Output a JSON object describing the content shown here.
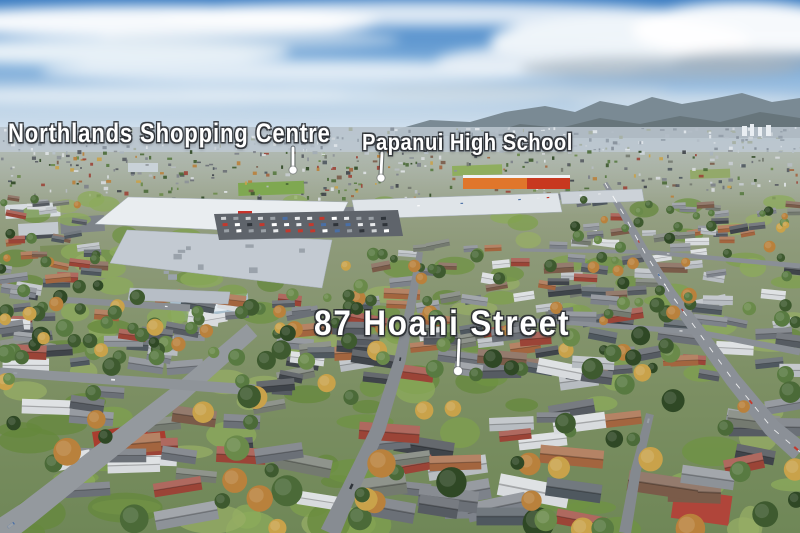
{
  "image": {
    "kind": "aerial-drone-photograph",
    "description": "Aerial view over a suburb: sky with clouds, distant hills and city, a large shopping centre at left, an orange retail building, a main arterial road at right, dense houses and green lawns in the foreground, with three white annotated place labels and leader lines."
  },
  "labels": [
    {
      "id": "northlands",
      "text": "Northlands Shopping Centre",
      "x": 8,
      "y": 119,
      "font_size": 27,
      "letter_spacing": 1,
      "scale_x": 0.82,
      "pointer": {
        "x1": 293,
        "y1": 148,
        "x2": 293,
        "y2": 167,
        "dot_x": 293,
        "dot_y": 170,
        "dot_r": 4
      }
    },
    {
      "id": "papanui",
      "text": "Papanui High School",
      "x": 362,
      "y": 130,
      "font_size": 23,
      "letter_spacing": 0.5,
      "scale_x": 0.88,
      "pointer": {
        "x1": 382,
        "y1": 153,
        "x2": 381,
        "y2": 174,
        "dot_x": 381,
        "dot_y": 178,
        "dot_r": 4
      }
    },
    {
      "id": "hoani",
      "text": "87 Hoani Street",
      "x": 314,
      "y": 306,
      "font_size": 35,
      "letter_spacing": 2,
      "scale_x": 0.9,
      "pointer": {
        "x1": 459,
        "y1": 340,
        "x2": 458,
        "y2": 366,
        "dot_x": 458,
        "dot_y": 371,
        "dot_r": 4.5
      }
    }
  ],
  "scene": {
    "seed": 1337,
    "sky": {
      "height": 152,
      "stops": [
        [
          "0%",
          "#3c7dc2"
        ],
        [
          "40%",
          "#74a7d8"
        ],
        [
          "75%",
          "#c2d6e8"
        ],
        [
          "100%",
          "#e2ecf4"
        ]
      ]
    },
    "clouds": [
      [
        150,
        22,
        230,
        16,
        "#ffffff",
        0.95
      ],
      [
        420,
        14,
        260,
        12,
        "#ffffff",
        0.8
      ],
      [
        90,
        52,
        200,
        13,
        "#f4f8fb",
        0.9
      ],
      [
        300,
        72,
        260,
        12,
        "#eef4f9",
        0.85
      ],
      [
        120,
        96,
        230,
        10,
        "#e8f0f6",
        0.8
      ],
      [
        380,
        96,
        200,
        9,
        "#e3edf4",
        0.7
      ],
      [
        250,
        40,
        150,
        10,
        "#dfe9f2",
        0.6
      ],
      [
        620,
        42,
        130,
        26,
        "#f7fafc",
        0.95
      ],
      [
        742,
        30,
        110,
        28,
        "#ffffff",
        0.95
      ],
      [
        545,
        62,
        110,
        16,
        "#eaf1f7",
        0.9
      ],
      [
        660,
        68,
        140,
        12,
        "#aab7c3",
        0.75
      ],
      [
        762,
        60,
        90,
        10,
        "#a3b1bd",
        0.7
      ],
      [
        520,
        92,
        150,
        8,
        "#c6d3de",
        0.6
      ],
      [
        690,
        102,
        120,
        7,
        "#dce6ee",
        0.7
      ]
    ],
    "hills": {
      "far": {
        "points": "395,130 430,120 470,122 505,112 545,106 575,112 600,101 628,106 652,97 682,104 712,99 742,93 772,102 800,98 800,136 395,136",
        "fill": "#7a8a94"
      },
      "near": {
        "points": "480,136 520,124 560,128 600,118 640,124 680,116 720,122 760,112 800,118 800,138 480,138",
        "fill": "#67757b"
      }
    },
    "city": {
      "y0": 127,
      "y1": 152,
      "base": "#b7c2cb",
      "count": 260,
      "colors": [
        "#dde3e8",
        "#b3bdc7",
        "#95a0ab",
        "#8a949f",
        "#ccd3d9",
        "#a7b1a6"
      ],
      "towers": [
        [
          742,
          126,
          5,
          10
        ],
        [
          750,
          124,
          4,
          12
        ],
        [
          758,
          127,
          4,
          9
        ],
        [
          766,
          125,
          5,
          11
        ]
      ]
    },
    "ground": {
      "stops": [
        [
          "0%",
          "#a8ae9d"
        ],
        [
          "30%",
          "#8e9a7a"
        ],
        [
          "65%",
          "#7c8f63"
        ],
        [
          "100%",
          "#6f8757"
        ]
      ]
    },
    "haze": {
      "color": "#bcc6c9",
      "y0": 150,
      "y1": 215
    },
    "parks": [
      [
        238,
        183,
        66,
        13,
        "#7fa851",
        -2
      ],
      [
        40,
        246,
        60,
        21,
        "#7b8e5b",
        -3
      ],
      [
        452,
        166,
        50,
        10,
        "#8fae5e",
        -2
      ],
      [
        690,
        170,
        40,
        9,
        "#93a96a",
        -2
      ]
    ],
    "patches": [
      {
        "x": 170,
        "y": 300,
        "w": 78,
        "h": 22,
        "rot": -5,
        "fill": "#a9bfcd"
      },
      {
        "x": 186,
        "y": 304,
        "w": 40,
        "h": 10,
        "rot": -5,
        "fill": "#e3ebf0"
      },
      {
        "x": 92,
        "y": 432,
        "w": 72,
        "h": 26,
        "rot": -9,
        "fill": "#a93d2f"
      },
      {
        "x": 675,
        "y": 488,
        "w": 58,
        "h": 30,
        "rot": 8,
        "fill": "#b0453a"
      },
      {
        "x": 128,
        "y": 163,
        "w": 30,
        "h": 9,
        "rot": 0,
        "fill": "#c9d2d8"
      },
      {
        "x": 60,
        "y": 218,
        "w": 44,
        "h": 16,
        "rot": -4,
        "fill": "#7d8389"
      },
      {
        "x": 20,
        "y": 228,
        "w": 34,
        "h": 12,
        "rot": -4,
        "fill": "#4a4f55"
      },
      {
        "x": 5,
        "y": 205,
        "w": 55,
        "h": 14,
        "rot": -3,
        "fill": "#d7dce0"
      },
      {
        "x": 18,
        "y": 224,
        "w": 40,
        "h": 12,
        "rot": -3,
        "fill": "#c3c9cf"
      }
    ],
    "roads": [
      {
        "name": "main-road",
        "pts": [
          [
            605,
            183
          ],
          [
            623,
            213
          ],
          [
            645,
            253
          ],
          [
            670,
            293
          ],
          [
            697,
            330
          ],
          [
            733,
            380
          ],
          [
            772,
            428
          ],
          [
            800,
            452
          ]
        ],
        "w0": 5,
        "w1": 20,
        "fill": "#8b9097",
        "dash": true,
        "cars": 8
      },
      {
        "name": "langdons-road",
        "pts": [
          [
            340,
            210
          ],
          [
            470,
            203
          ],
          [
            600,
            194
          ]
        ],
        "w0": 5,
        "w1": 6,
        "fill": "#7e838a",
        "dash": false,
        "cars": 7
      },
      {
        "name": "cross-street-1",
        "pts": [
          [
            520,
            250
          ],
          [
            648,
            252
          ],
          [
            800,
            266
          ]
        ],
        "w0": 3,
        "w1": 5,
        "fill": "#8a8f96",
        "dash": false,
        "cars": 1
      },
      {
        "name": "cross-street-2",
        "pts": [
          [
            500,
            318
          ],
          [
            697,
            332
          ],
          [
            800,
            352
          ]
        ],
        "w0": 4,
        "w1": 7,
        "fill": "#8a8f96",
        "dash": false,
        "cars": 2
      },
      {
        "name": "hoani-street",
        "pts": [
          [
            420,
            252
          ],
          [
            412,
            300
          ],
          [
            400,
            360
          ],
          [
            378,
            430
          ],
          [
            345,
            500
          ],
          [
            330,
            533
          ]
        ],
        "w0": 6,
        "w1": 20,
        "fill": "#878c92",
        "dash": false,
        "cars": 2
      },
      {
        "name": "foreground-road",
        "pts": [
          [
            252,
            330
          ],
          [
            180,
            393
          ],
          [
            95,
            460
          ],
          [
            28,
            513
          ],
          [
            0,
            533
          ]
        ],
        "w0": 16,
        "w1": 26,
        "fill": "#94999e",
        "dash": false,
        "cars": 3
      },
      {
        "name": "side-street",
        "pts": [
          [
            0,
            372
          ],
          [
            130,
            381
          ],
          [
            255,
            390
          ]
        ],
        "w0": 9,
        "w1": 11,
        "fill": "#8f9499",
        "dash": false,
        "cars": 2
      },
      {
        "name": "mid-street",
        "pts": [
          [
            66,
            300
          ],
          [
            190,
            308
          ]
        ],
        "w0": 6,
        "w1": 7,
        "fill": "#8a8f94",
        "dash": false,
        "cars": 1
      },
      {
        "name": "lane",
        "pts": [
          [
            650,
            414
          ],
          [
            636,
            470
          ],
          [
            625,
            533
          ]
        ],
        "w0": 8,
        "w1": 12,
        "fill": "#84898f",
        "dash": false,
        "cars": 1
      }
    ],
    "mall": {
      "exclusion": [
        [
          88,
          188,
          572,
          244
        ],
        [
          100,
          244,
          345,
          294
        ]
      ],
      "roofs": [
        {
          "points": "95,224 128,197 348,202 332,235",
          "fill": "#e9edf0"
        },
        {
          "points": "110,263 127,230 332,240 322,288",
          "fill": "#c3cad2"
        },
        {
          "points": "352,200 558,193 562,212 356,219",
          "fill": "#dfe4e8"
        },
        {
          "points": "130,288 230,292 228,304 128,300",
          "fill": "#b7bec6"
        },
        {
          "points": "560,192 642,189 644,201 562,204",
          "fill": "#ccd2d8"
        }
      ],
      "panel_line": "#a9b2bc",
      "orange_store": {
        "x": 463,
        "y": 178,
        "w": 107,
        "h": 11,
        "fill": "#e0762b",
        "accent": "#c8381f",
        "accent_x": 527,
        "accent_w": 43,
        "top": "#f0f2f4"
      },
      "red_sign": {
        "x": 238,
        "y": 211,
        "w": 14,
        "h": 8,
        "fill": "#c8332b"
      },
      "carpark": {
        "points": "214,214 398,210 403,236 219,240",
        "fill": "#5f646b"
      },
      "car_colors": [
        "#ffffff",
        "#e8eaec",
        "#c3392e",
        "#2f343a",
        "#4a6fa5",
        "#9aa0a6",
        "#d0d3d6"
      ]
    },
    "suburb": {
      "roof_colors": [
        "#6b7077",
        "#565b62",
        "#7d828a",
        "#3f444a",
        "#8d9298",
        "#a3653f",
        "#7a5b49",
        "#9b4437",
        "#b7bcc1",
        "#d8dbde",
        "#4f585f",
        "#747a70"
      ],
      "tree_colors": [
        "#3e5a2f",
        "#4b6a38",
        "#587a41",
        "#2f4825",
        "#6a8a4a",
        "#b9813c",
        "#c9a24a"
      ],
      "lawn_colors": [
        "#7fa04e",
        "#6f9343",
        "#8cab5b",
        "#65883c",
        "#97ae66"
      ],
      "mid_band": {
        "y0": 150,
        "y1": 198,
        "count": 340
      },
      "main_band": {
        "y0": 198,
        "y1": 382,
        "houses": 230,
        "trees": 170,
        "lawns": 90
      },
      "fore_band": {
        "y0": 382,
        "y1": 533,
        "houses": 64,
        "trees": 52,
        "lawns": 46
      }
    },
    "pointer": {
      "color": "#ffffff",
      "shadow": "rgba(30,35,40,0.5)",
      "dot_rim": "rgba(40,45,50,0.4)"
    }
  }
}
